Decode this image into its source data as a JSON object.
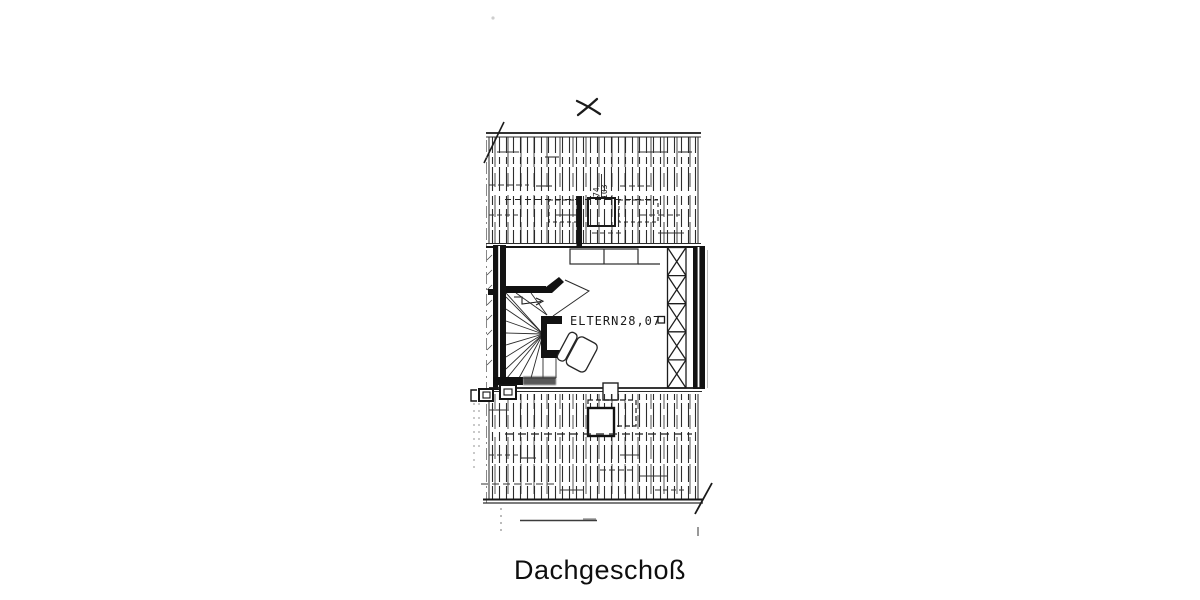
{
  "colors": {
    "paper": "#ffffff",
    "ink": "#1c1c1c",
    "faint": "#777777"
  },
  "floor_plan": {
    "title": "Dachgeschoß",
    "room": {
      "name": "ELTERN",
      "area": "28,07"
    },
    "window_dimension": {
      "top": "74",
      "bottom": "103"
    }
  }
}
